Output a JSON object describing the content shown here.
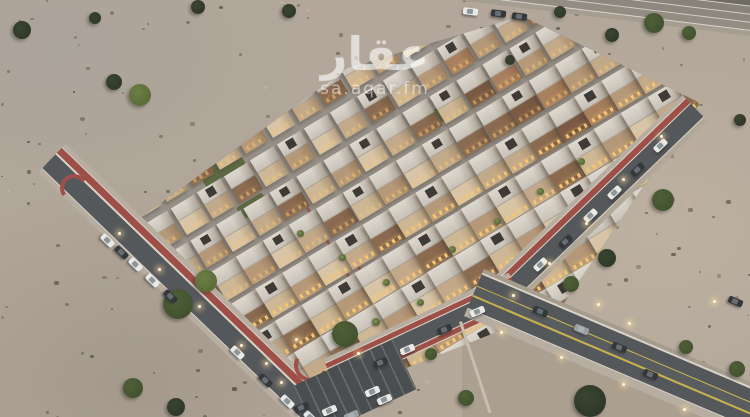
{
  "watermark": {
    "logo_text": "عقار",
    "site_text": "sa.aqar.fm"
  },
  "colors": {
    "street_base_a": "#9a948c",
    "street_base_b": "#8f8a84",
    "asphalt": "#55585b",
    "red_path": "#9e5048",
    "sidewalk": "#b7aea1",
    "curb": "#d8d3c8",
    "white_line": "#d9d4c9",
    "yellow_line": "#c9b24a",
    "shoulder": "#a59c8e",
    "plot_sand": "#ab9f90",
    "plot_edge": "#c6beb0",
    "parking": "#4a4e50",
    "glow": "#f4c573",
    "car_white": "#e9eae8",
    "car_dark": "#34383b",
    "car_gray": "#9aa0a2",
    "tree_dark_a": "#3a4431",
    "tree_dark_b": "#2f3829",
    "tree_green_a": "#4f6038",
    "tree_green_b": "#42512f",
    "tree_bright_a": "#6c8045",
    "tree_bright_b": "#596b37",
    "lawn": "#5d6b44"
  },
  "compound": {
    "clip": [
      [
        140,
        218
      ],
      [
        348,
        68
      ],
      [
        522,
        16
      ],
      [
        700,
        103
      ],
      [
        562,
        306
      ],
      [
        318,
        403
      ]
    ],
    "lattice": {
      "origin": [
        140,
        218
      ],
      "u": [
        26.6,
        -16.0
      ],
      "v": [
        20,
        33
      ],
      "rows": 9,
      "cols": 18,
      "villa_w": 26,
      "villa_h": 30,
      "angle": -31
    },
    "palette": [
      "#d8c4a6",
      "#cdb795",
      "#c2a98a",
      "#b59878",
      "#8a6a50"
    ],
    "brown_palette": [
      "#a9805e",
      "#8a6a50",
      "#b59878",
      "#7b5a44",
      "#c2a98a"
    ],
    "green_patches": [
      [
        196,
        170,
        46,
        20
      ],
      [
        420,
        118,
        34,
        15
      ],
      [
        468,
        168,
        30,
        13
      ],
      [
        236,
        208,
        30,
        14
      ]
    ],
    "red_strips": [
      [
        302,
        196,
        120
      ],
      [
        442,
        222,
        110
      ],
      [
        356,
        260,
        95
      ]
    ]
  },
  "roads": [
    {
      "name": "highway-top",
      "x": 410,
      "y": -26,
      "len": 360,
      "angle": 7,
      "stripes": [
        [
          10,
          "#6f6c64"
        ],
        [
          1,
          "rgba(255,255,255,.45)"
        ],
        [
          7,
          "#87837a"
        ],
        [
          1,
          "rgba(255,255,255,.45)"
        ],
        [
          7,
          "#8d887e"
        ],
        [
          1,
          "rgba(255,255,255,.45)"
        ],
        [
          7,
          "#928d82"
        ],
        [
          1,
          "rgba(255,255,255,.55)"
        ],
        [
          5,
          "#a59d90"
        ]
      ]
    },
    {
      "name": "road-left",
      "x": 52,
      "y": 158,
      "len": 372,
      "angle": 44,
      "stripes": [
        [
          5,
          "#b7aea1"
        ],
        [
          1,
          "#d8d3c8"
        ],
        [
          7,
          "#9e5048"
        ],
        [
          1.5,
          "#d9d4c9"
        ],
        [
          19,
          "#55585b"
        ],
        [
          1.5,
          "#d9d4c9"
        ],
        [
          5,
          "#b7aea1"
        ]
      ]
    },
    {
      "name": "road-right-upper",
      "x": 695,
      "y": 108,
      "len": 258,
      "angle": 136,
      "stripes": [
        [
          5,
          "#b0a799"
        ],
        [
          1,
          "#d9d4c9"
        ],
        [
          18,
          "#55585b"
        ],
        [
          1,
          "#d9d4c9"
        ],
        [
          6,
          "#9e5048"
        ],
        [
          1,
          "#d8d3c8"
        ],
        [
          4,
          "#b7aea1"
        ]
      ]
    },
    {
      "name": "road-right-lower",
      "x": 516,
      "y": 288,
      "len": 205,
      "angle": 155,
      "stripes": [
        [
          1,
          "#d9d4c9"
        ],
        [
          5,
          "#9e5048"
        ],
        [
          1,
          "#d9d4c9"
        ],
        [
          16,
          "#55585b"
        ],
        [
          1,
          "#d9d4c9"
        ],
        [
          5,
          "#9e5048"
        ],
        [
          1,
          "#d8d3c8"
        ],
        [
          4,
          "#b7aea1"
        ]
      ]
    },
    {
      "name": "road-bottom-right",
      "x": 474,
      "y": 292,
      "len": 305,
      "angle": 23,
      "stripes": [
        [
          4,
          "#a59c8e"
        ],
        [
          1.5,
          "#d9d4c9"
        ],
        [
          12,
          "#55585b"
        ],
        [
          1.5,
          "#c9b24a"
        ],
        [
          9,
          "#5a5d60"
        ],
        [
          1.5,
          "#c9b24a"
        ],
        [
          12,
          "#55585b"
        ],
        [
          1.5,
          "#d9d4c9"
        ],
        [
          8,
          "#b7aea1"
        ]
      ]
    }
  ],
  "plot": {
    "clip": [
      [
        462,
        318
      ],
      [
        748,
        417
      ],
      [
        462,
        417
      ]
    ],
    "edge_line": {
      "x": 459,
      "y": 322,
      "len": 96,
      "angle": 72
    }
  },
  "parking": {
    "x": 300,
    "y": 360,
    "w": 110,
    "h": 55,
    "angle": -25
  },
  "red_curves": [
    {
      "x": 294,
      "y": 348,
      "size": 26,
      "angle": -20
    },
    {
      "x": 60,
      "y": 174,
      "size": 20,
      "angle": 100
    }
  ],
  "trees": [
    [
      140,
      95,
      11,
      "bright"
    ],
    [
      114,
      82,
      8,
      "dark"
    ],
    [
      22,
      30,
      9,
      "dark"
    ],
    [
      198,
      7,
      7,
      "dark"
    ],
    [
      289,
      11,
      7,
      "dark"
    ],
    [
      560,
      12,
      6,
      "dark"
    ],
    [
      612,
      35,
      7,
      "dark"
    ],
    [
      654,
      23,
      10,
      "green"
    ],
    [
      689,
      33,
      7,
      "green"
    ],
    [
      740,
      120,
      6,
      "dark"
    ],
    [
      663,
      200,
      11,
      "green"
    ],
    [
      607,
      258,
      9,
      "dark"
    ],
    [
      571,
      284,
      8,
      "green"
    ],
    [
      178,
      304,
      15,
      "green"
    ],
    [
      206,
      281,
      11,
      "bright"
    ],
    [
      133,
      388,
      10,
      "green"
    ],
    [
      176,
      407,
      9,
      "dark"
    ],
    [
      345,
      334,
      13,
      "green"
    ],
    [
      590,
      401,
      16,
      "dark"
    ],
    [
      686,
      347,
      7,
      "green"
    ],
    [
      737,
      369,
      8,
      "green"
    ],
    [
      466,
      398,
      8,
      "green"
    ],
    [
      431,
      354,
      6,
      "green"
    ],
    [
      510,
      60,
      5,
      "dark"
    ],
    [
      95,
      18,
      6,
      "dark"
    ]
  ],
  "palms": [
    [
      376,
      322,
      8
    ],
    [
      300,
      233,
      7
    ],
    [
      342,
      257,
      7
    ],
    [
      386,
      282,
      7
    ],
    [
      452,
      249,
      7
    ],
    [
      497,
      221,
      7
    ],
    [
      540,
      191,
      7
    ],
    [
      581,
      161,
      7
    ],
    [
      420,
      302,
      7
    ]
  ],
  "cars": [
    [
      100,
      237,
      44,
      "white"
    ],
    [
      114,
      249,
      44,
      "dark"
    ],
    [
      128,
      261,
      44,
      "white"
    ],
    [
      145,
      277,
      44,
      "white"
    ],
    [
      163,
      293,
      44,
      "dark"
    ],
    [
      230,
      349,
      44,
      "white"
    ],
    [
      258,
      377,
      44,
      "dark"
    ],
    [
      280,
      398,
      44,
      "white"
    ],
    [
      303,
      414,
      44,
      "white"
    ],
    [
      653,
      142,
      -44,
      "white"
    ],
    [
      630,
      166,
      -44,
      "dark"
    ],
    [
      607,
      189,
      -44,
      "white"
    ],
    [
      583,
      212,
      -44,
      "white"
    ],
    [
      558,
      238,
      -44,
      "dark"
    ],
    [
      533,
      261,
      -44,
      "white"
    ],
    [
      470,
      308,
      -24,
      "white"
    ],
    [
      437,
      326,
      -24,
      "dark"
    ],
    [
      400,
      346,
      -24,
      "white"
    ],
    [
      373,
      359,
      -24,
      "dark"
    ],
    [
      533,
      308,
      23,
      "dark"
    ],
    [
      574,
      326,
      23,
      "gray"
    ],
    [
      612,
      344,
      23,
      "dark"
    ],
    [
      643,
      371,
      23,
      "dark"
    ],
    [
      728,
      298,
      23,
      "dark"
    ],
    [
      463,
      8,
      7,
      "white"
    ],
    [
      491,
      10,
      7,
      "dark"
    ],
    [
      512,
      13,
      7,
      "dark"
    ],
    [
      365,
      388,
      -24,
      "white"
    ],
    [
      377,
      396,
      -24,
      "white"
    ],
    [
      322,
      407,
      -24,
      "white"
    ],
    [
      344,
      412,
      -24,
      "gray"
    ],
    [
      294,
      404,
      -24,
      "dark"
    ]
  ],
  "lights": [
    [
      118,
      232
    ],
    [
      158,
      268
    ],
    [
      198,
      305
    ],
    [
      240,
      344
    ],
    [
      280,
      381
    ],
    [
      295,
      338
    ],
    [
      265,
      362
    ],
    [
      660,
      135
    ],
    [
      622,
      178
    ],
    [
      585,
      222
    ],
    [
      548,
      262
    ],
    [
      512,
      294
    ],
    [
      357,
      352
    ],
    [
      500,
      331
    ],
    [
      560,
      356
    ],
    [
      622,
      383
    ],
    [
      683,
      408
    ],
    [
      713,
      300
    ],
    [
      597,
      303
    ],
    [
      628,
      322
    ]
  ],
  "shrub_colors": [
    "#5d5747",
    "#4a4a3a",
    "#6b6355",
    "#756d5c"
  ],
  "tuft_color": "#c7bcab"
}
